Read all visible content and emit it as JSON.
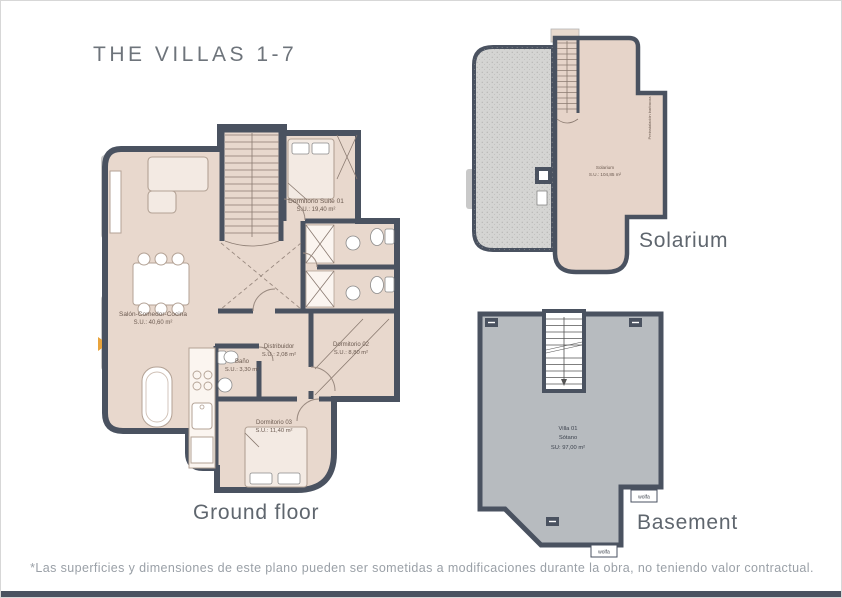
{
  "page": {
    "title": "THE VILLAS 1-7",
    "disclaimer": "*Las superficies y dimensiones de este plano pueden ser sometidas a modificaciones durante la obra, no teniendo valor contractual."
  },
  "colors": {
    "wall": "#4a5260",
    "room_fill": "#e8d8cd",
    "solarium_tile": "#d5d5d3",
    "basement_fill": "#b7bbbf",
    "heading_text": "#5f666e",
    "entrance_marker": "#e9a43c"
  },
  "ground_floor": {
    "label": "Ground floor",
    "rooms": [
      {
        "name": "Salón-Comedor-Cocina",
        "area": "S.U.: 40,60 m²"
      },
      {
        "name": "Dormitorio Suite 01",
        "area": "S.U.: 19,40 m²"
      },
      {
        "name": "Distribuidor",
        "area": "S.U.: 2,08 m²"
      },
      {
        "name": "Dormitorio 02",
        "area": "S.U.: 8,80 m²"
      },
      {
        "name": "Baño",
        "area": "S.U.: 3,30 m²"
      },
      {
        "name": "Dormitorio 03",
        "area": "S.U.: 11,40 m²"
      }
    ]
  },
  "solarium": {
    "label": "Solarium",
    "room": {
      "name": "Solarium",
      "area": "S.U.: 104,85 m²"
    },
    "note_vertical": "Preinstalación barbacoa"
  },
  "basement": {
    "label": "Basement",
    "room": {
      "name": "Villa 01",
      "sub": "Sótano",
      "area": "SU: 97,00 m²"
    },
    "drain_label": "wolfa"
  }
}
